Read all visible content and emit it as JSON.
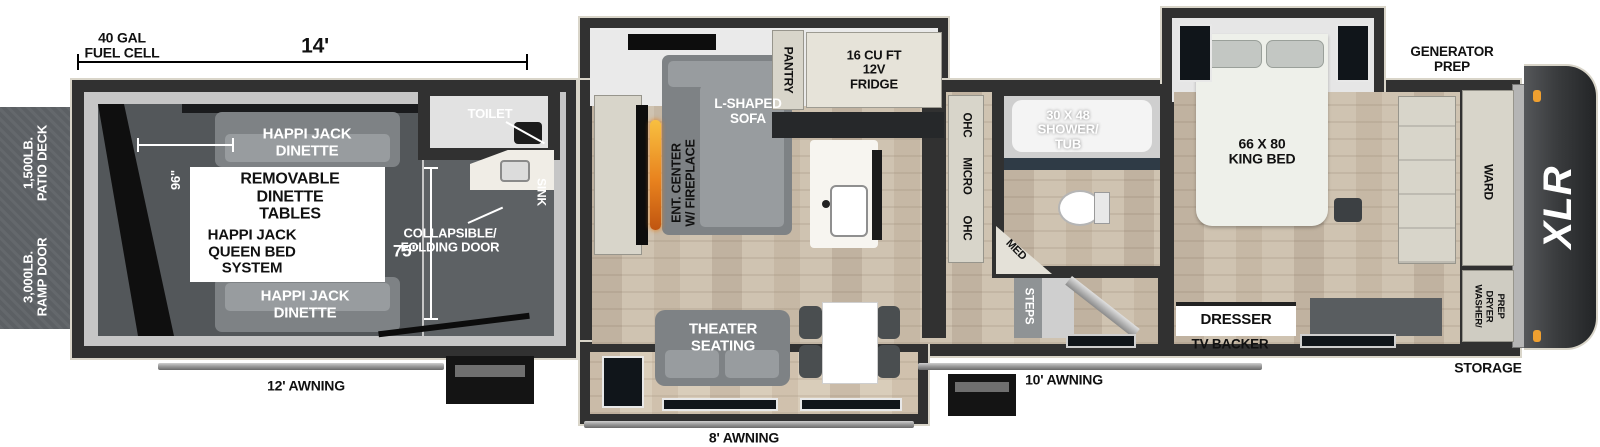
{
  "title": "XLR toy hauler fifth wheel floorplan",
  "palette": {
    "wall": "#313131",
    "outline": "#d9d5c9",
    "wood": "#cfc3b1",
    "garage_floor": "#53575a",
    "deck": "#5c6064",
    "slide": "#eaeaea",
    "cabinet": "#d8d5ca",
    "flame_orange": "#e8821e",
    "marker_orange": "#f0a030",
    "label_white": "#ffffff",
    "label_black": "#111111"
  },
  "dimensions": {
    "fuel_cell": "40 GAL\nFUEL CELL",
    "garage_length": "14'",
    "garage_width": "96\"",
    "garage_opening": "75\""
  },
  "exterior": {
    "patio_deck": "1,500LB.\nPATIO DECK",
    "ramp_door": "3,000LB.\nRAMP DOOR",
    "generator_prep": "GENERATOR\nPREP",
    "storage": "STORAGE",
    "awning_rear": "12' AWNING",
    "awning_mid": "8' AWNING",
    "awning_front": "10' AWNING",
    "brand_logo": "XLR"
  },
  "garage": {
    "dinette_top": "HAPPI JACK\nDINETTE",
    "removable_tables": "REMOVABLE\nDINETTE\nTABLES",
    "queen_bed": "HAPPI JACK\nQUEEN BED\nSYSTEM",
    "dinette_bottom": "HAPPI JACK\nDINETTE",
    "toilet": "TOILET",
    "sink": "SINK",
    "folding_door": "COLLAPSIBLE/\nFOLDING DOOR"
  },
  "living": {
    "sofa": "L-SHAPED\nSOFA",
    "ent_center": "ENT. CENTER\nW/ FIREPLACE",
    "theater": "THEATER\nSEATING",
    "pantry": "PANTRY",
    "fridge": "16 CU FT\n12V\nFRIDGE"
  },
  "kitchen": {
    "ohc_top": "OHC",
    "micro": "MICRO",
    "ohc_bottom": "OHC"
  },
  "bath": {
    "shower": "30 X 48\nSHOWER/\nTUB",
    "med": "MED",
    "steps": "STEPS"
  },
  "bedroom": {
    "king_bed": "66 X 80\nKING BED",
    "dresser": "DRESSER",
    "tv_backer": "TV BACKER",
    "ward": "WARD",
    "washer_dryer": "WASHER/\nDRYER\nPREP"
  }
}
